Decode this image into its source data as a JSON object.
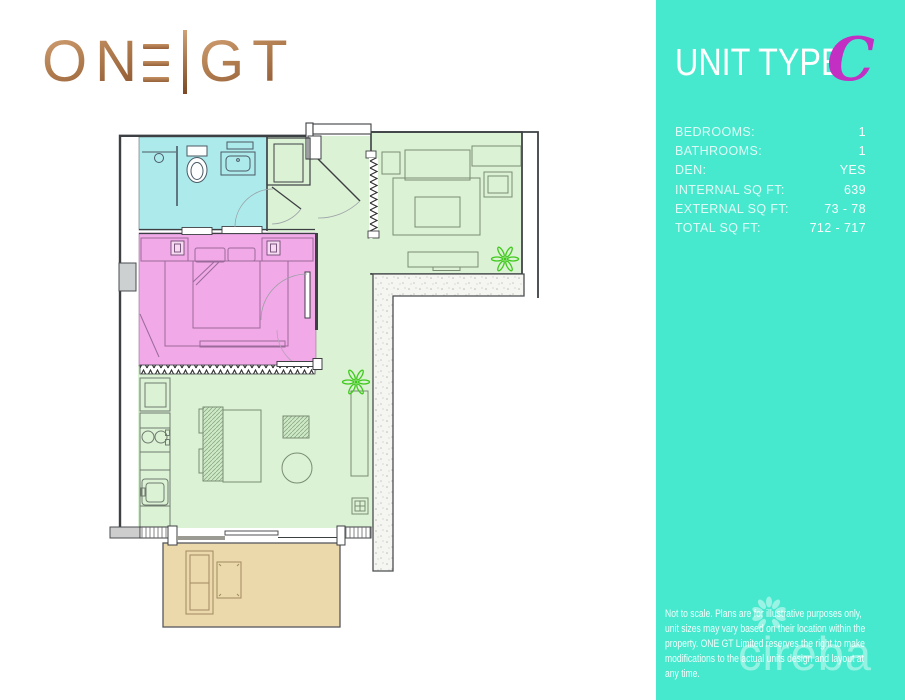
{
  "brand": {
    "logo_left": "ON",
    "logo_right": "GT"
  },
  "sidebar": {
    "panel_color": "#47E9CE",
    "title": "UNIT TYPE",
    "unit_letter": "C",
    "unit_letter_color": "#C42FC3",
    "specs": [
      {
        "label": "BEDROOMS:",
        "value": "1"
      },
      {
        "label": "BATHROOMS:",
        "value": "1"
      },
      {
        "label": "DEN:",
        "value": "YES"
      },
      {
        "label": "INTERNAL SQ FT:",
        "value": "639"
      },
      {
        "label": "EXTERNAL SQ FT:",
        "value": "73 - 78"
      },
      {
        "label": "TOTAL SQ FT:",
        "value": "712 - 717"
      }
    ],
    "disclaimer": "Not to scale. Plans are for illustrative purposes only, unit sizes may vary based on their location within the property. ONE GT Limited reserves the right to make modifications to the actual units design and layout at any time.",
    "watermark": "cireba"
  },
  "floorplan": {
    "colors": {
      "bathroom": "#ADEAEB",
      "bedroom": "#F1A9E8",
      "living": "#DBF2D5",
      "den": "#DBF2D5",
      "balcony": "#EBD9AC",
      "plant": "#3FC91C",
      "wall": "#3D4043"
    },
    "rooms": [
      {
        "name": "bathroom"
      },
      {
        "name": "bedroom"
      },
      {
        "name": "entry-hall"
      },
      {
        "name": "den"
      },
      {
        "name": "living-dining-kitchen"
      },
      {
        "name": "balcony"
      }
    ]
  }
}
